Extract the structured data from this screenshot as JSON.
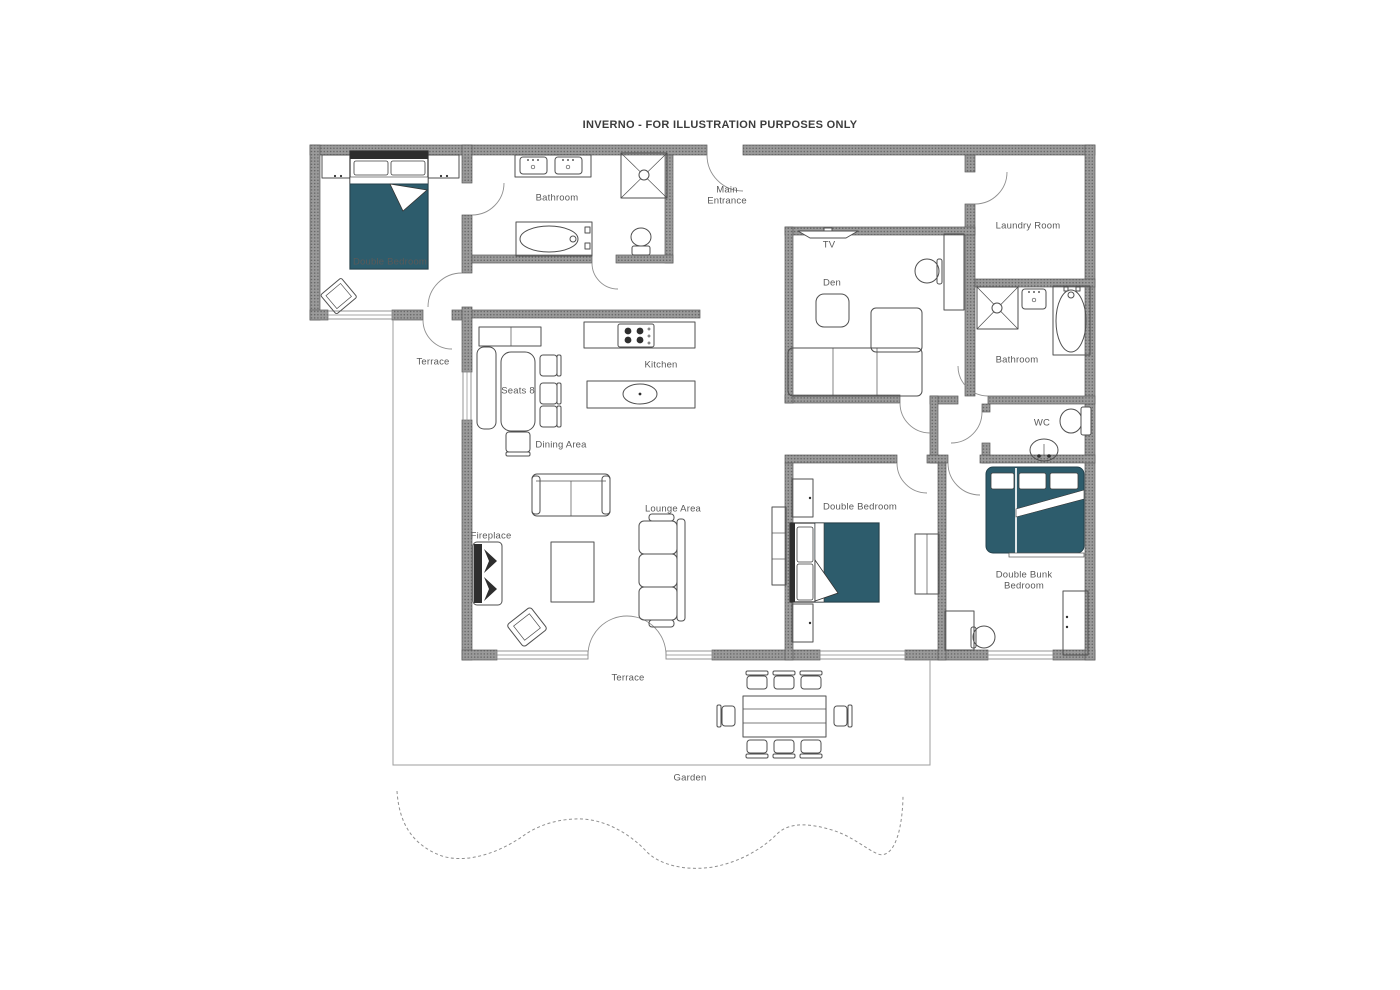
{
  "title": "INVERNO - FOR ILLUSTRATION PURPOSES ONLY",
  "labels": {
    "double_bedroom_top": "Double Bedroom",
    "bathroom_top": "Bathroom",
    "main_entrance": "Main Entrance",
    "laundry_room": "Laundry Room",
    "tv": "TV",
    "den": "Den",
    "bathroom_right": "Bathroom",
    "wc": "WC",
    "kitchen": "Kitchen",
    "dining_table_seats": "Seats 8",
    "dining_area": "Dining Area",
    "terrace_left": "Terrace",
    "fireplace": "Fireplace",
    "lounge_area": "Lounge Area",
    "double_bedroom_bottom": "Double Bedroom",
    "double_bunk_bedroom": "Double Bunk Bedroom",
    "terrace_bottom": "Terrace",
    "garden": "Garden"
  },
  "colors": {
    "wall": "#9a9a9a",
    "wall_dot": "#636363",
    "wall_edge": "#5a5a5a",
    "line": "#4f4f4f",
    "bed": "#2d5c6c",
    "label": "#595959"
  }
}
